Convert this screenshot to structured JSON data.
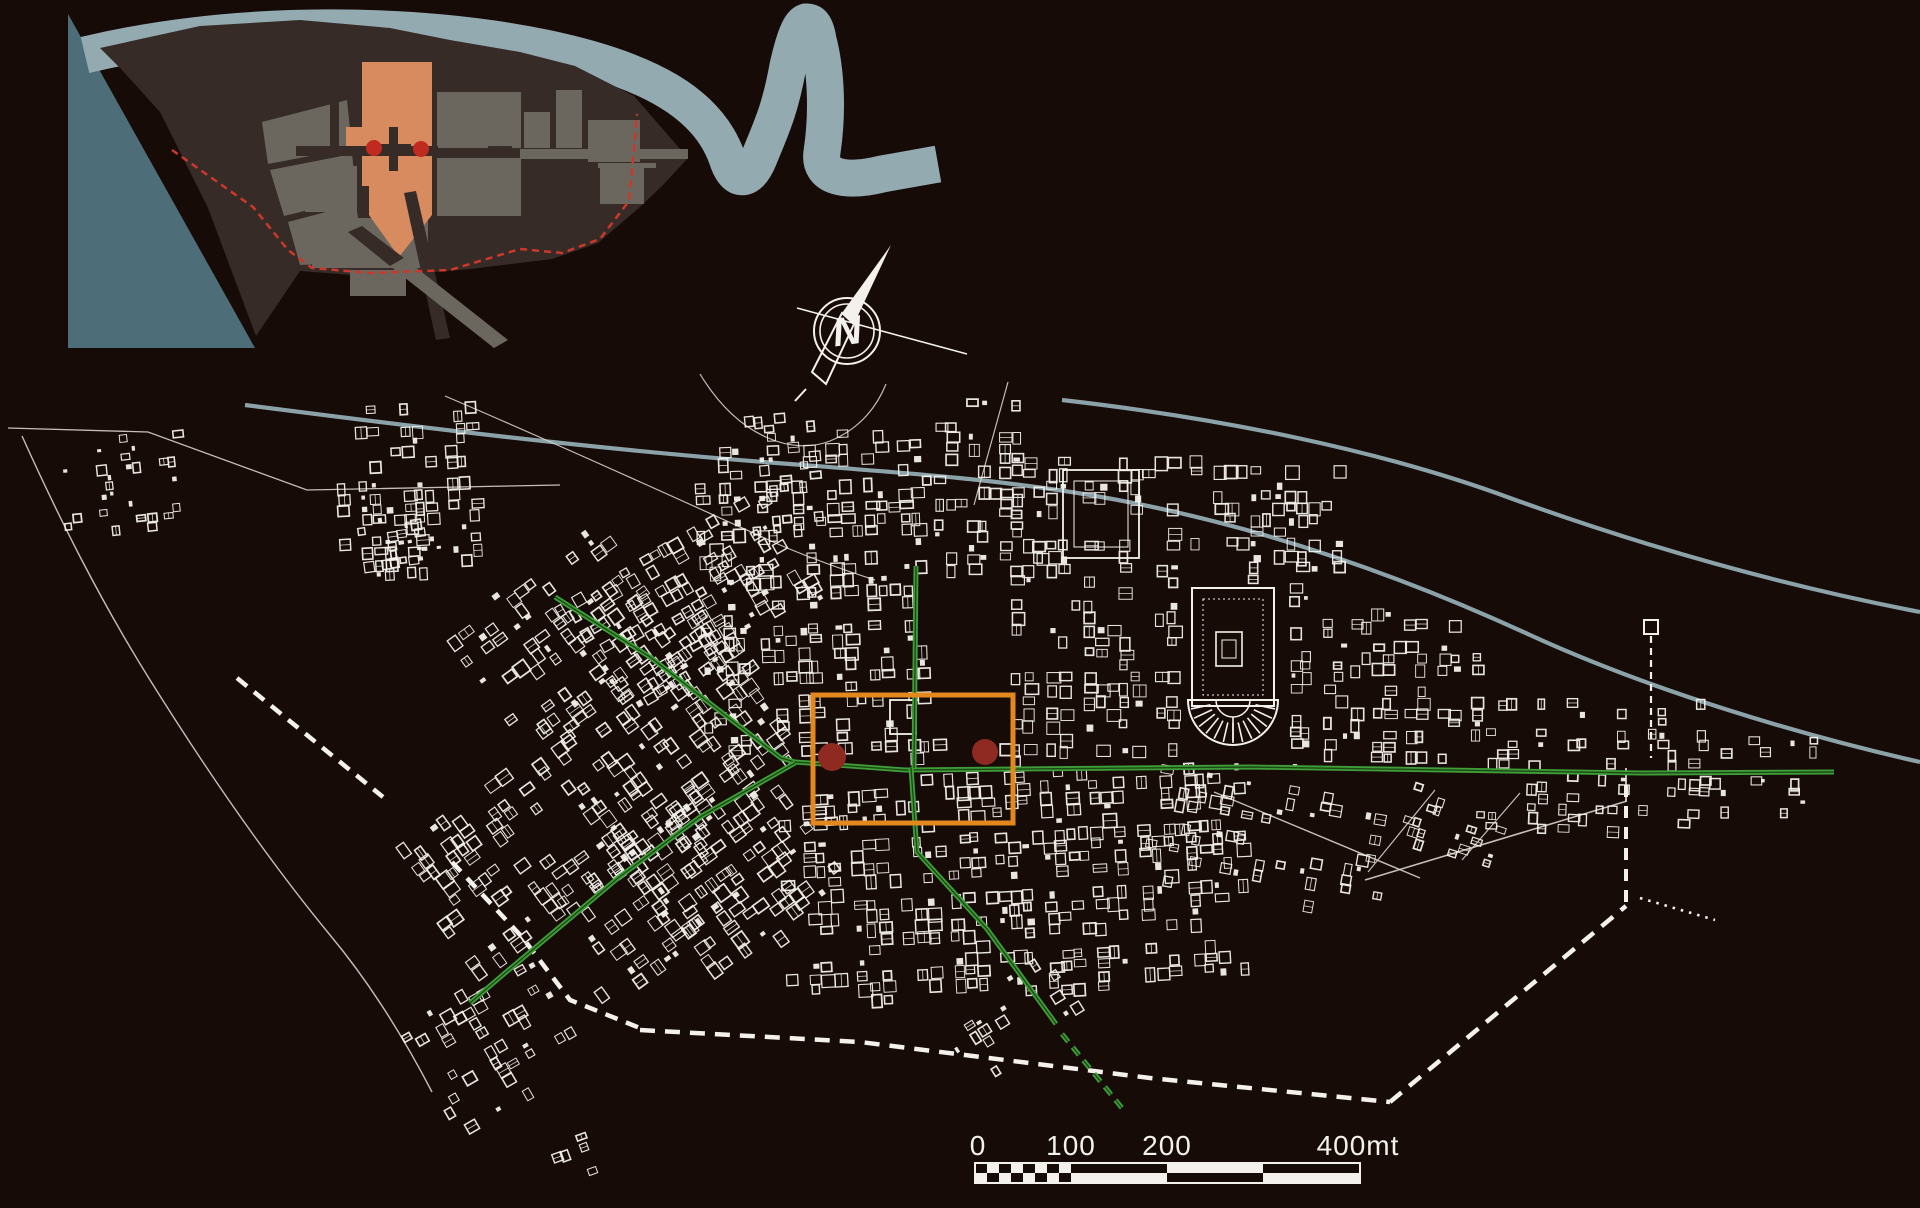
{
  "canvas": {
    "w": 1920,
    "h": 1208,
    "bg": "#170b08"
  },
  "palette": {
    "white": "#f4f1ec",
    "faint_white": "#d8d2cb",
    "river": "#8ba2a9",
    "band": "#94aab1",
    "sea": "#4d6d78",
    "land": "#362b26",
    "block": "#6b675f",
    "salmon": "#d98b60",
    "inset_red": "#c02a1f",
    "boundary_red": "#cb382b",
    "green": "#3f9e38",
    "green_dark": "#1c4a16",
    "orange": "#e2881f",
    "dot_red": "#8e2a22",
    "bg": "#170b08"
  },
  "scalebar": {
    "name": "scale-bar",
    "x": 975,
    "y": 1163,
    "h": 20,
    "len": 385,
    "checker_end": 96,
    "checker_cols": 8,
    "segments": [
      {
        "from": 96,
        "to": 192,
        "black": "top"
      },
      {
        "from": 192,
        "to": 288,
        "black": "bottom"
      },
      {
        "from": 288,
        "to": 385,
        "black": "top"
      }
    ],
    "labels": [
      {
        "t": "0",
        "x": 978
      },
      {
        "t": "100",
        "x": 1071
      },
      {
        "t": "200",
        "x": 1167
      },
      {
        "t": "400mt",
        "x": 1358
      }
    ],
    "font_size": 28
  },
  "compass": {
    "name": "north-arrow",
    "cx": 847,
    "cy": 331,
    "r_outer": 33,
    "r_inner": 27,
    "letter": "N",
    "letter_size": 40,
    "blade_filled": [
      [
        891,
        245
      ],
      [
        854,
        324
      ],
      [
        842,
        313
      ]
    ],
    "blade_outline": [
      [
        854,
        324
      ],
      [
        826,
        384
      ],
      [
        812,
        372
      ],
      [
        842,
        313
      ]
    ],
    "cross_line": [
      797,
      308,
      967,
      354
    ],
    "tail_tick": [
      806,
      389,
      795,
      401
    ]
  },
  "inset": {
    "name": "inset-overview-map",
    "sea": [
      [
        68,
        14
      ],
      [
        255,
        348
      ],
      [
        68,
        348
      ]
    ],
    "band": "M 85,55 C 240,18 420,22 545,48 C 650,70 708,104 727,158 C 734,181 748,185 759,158 C 772,126 780,110 788,66 C 793,44 799,24 806,22 C 812,22 816,26 818,40 C 826,70 828,112 822,152 C 818,178 846,183 882,174 L 938,164",
    "band_width": 37,
    "land": [
      [
        100,
        48
      ],
      [
        200,
        26
      ],
      [
        300,
        20
      ],
      [
        390,
        28
      ],
      [
        450,
        40
      ],
      [
        520,
        52
      ],
      [
        575,
        66
      ],
      [
        634,
        96
      ],
      [
        688,
        158
      ],
      [
        663,
        185
      ],
      [
        640,
        207
      ],
      [
        598,
        243
      ],
      [
        552,
        259
      ],
      [
        470,
        269
      ],
      [
        378,
        277
      ],
      [
        300,
        271
      ],
      [
        256,
        336
      ],
      [
        208,
        208
      ],
      [
        160,
        112
      ],
      [
        122,
        70
      ]
    ],
    "blocks": [
      {
        "poly": [
          [
            262,
            122
          ],
          [
            347,
            100
          ],
          [
            352,
            148
          ],
          [
            268,
            164
          ]
        ]
      },
      {
        "poly": [
          [
            270,
            170
          ],
          [
            352,
            154
          ],
          [
            357,
            198
          ],
          [
            284,
            216
          ]
        ]
      },
      {
        "poly": [
          [
            288,
            222
          ],
          [
            356,
            204
          ],
          [
            364,
            262
          ],
          [
            300,
            265
          ]
        ]
      },
      {
        "rect": [
          437,
          92,
          84,
          56
        ]
      },
      {
        "rect": [
          437,
          158,
          84,
          58
        ]
      },
      {
        "rect": [
          524,
          112,
          26,
          36
        ]
      },
      {
        "rect": [
          556,
          90,
          26,
          58
        ]
      },
      {
        "rect": [
          588,
          120,
          52,
          42
        ]
      },
      {
        "rect": [
          600,
          166,
          44,
          38
        ]
      },
      {
        "rect": [
          305,
          166,
          52,
          46
        ]
      },
      {
        "rect": [
          312,
          218,
          116,
          50
        ]
      },
      {
        "rect": [
          350,
          270,
          56,
          26
        ]
      },
      {
        "rect": [
          487,
          96,
          26,
          50
        ]
      }
    ],
    "theater_cut": {
      "cx": 500,
      "cy": 146,
      "r": 12
    },
    "salmon_poly": [
      [
        362,
        62
      ],
      [
        432,
        62
      ],
      [
        432,
        215
      ],
      [
        399,
        257
      ],
      [
        369,
        215
      ],
      [
        369,
        186
      ],
      [
        362,
        186
      ]
    ],
    "salmon_notch": [
      346,
      127,
      16,
      28
    ],
    "roads_dark": [
      {
        "rect": [
          296,
          146,
          142,
          10
        ]
      },
      {
        "rect": [
          330,
          88,
          9,
          58
        ]
      },
      {
        "poly": [
          [
            348,
            232
          ],
          [
            362,
            226
          ],
          [
            404,
            258
          ],
          [
            390,
            266
          ]
        ]
      },
      {
        "poly": [
          [
            404,
            193
          ],
          [
            416,
            191
          ],
          [
            450,
            338
          ],
          [
            436,
            340
          ]
        ]
      }
    ],
    "roads_gray": [
      {
        "rect": [
          520,
          149,
          168,
          10
        ]
      },
      {
        "rect": [
          598,
          163,
          58,
          5
        ]
      },
      {
        "poly": [
          [
            390,
            266
          ],
          [
            404,
            258
          ],
          [
            508,
            340
          ],
          [
            494,
            348
          ]
        ]
      }
    ],
    "cross": [
      [
        389,
        127,
        9,
        44
      ],
      [
        376,
        144,
        35,
        9
      ]
    ],
    "dots": [
      {
        "cx": 374,
        "cy": 148,
        "r": 8
      },
      {
        "cx": 421,
        "cy": 149,
        "r": 8
      }
    ],
    "boundary": "M 172,150 L 253,207 L 288,250 L 312,268 L 370,273 L 450,270 L 520,249 L 562,253 L 600,239 L 629,201 L 634,150 L 637,114",
    "boundary_width": 2.5,
    "boundary_dash": "7 5"
  },
  "main": {
    "name": "excavation-plan",
    "rivers": [
      {
        "name": "river-upper",
        "d": "M 1062,400 C 1220,418 1380,450 1510,498 C 1640,545 1780,585 1920,612",
        "w": 4.2
      },
      {
        "name": "river-lower",
        "d": "M 245,405 C 400,425 600,450 790,464 C 920,474 1000,480 1090,495 C 1250,522 1400,575 1530,635 C 1650,690 1800,735 1920,762",
        "w": 4.2
      }
    ],
    "thin_lines": [
      {
        "name": "coastline",
        "d": "M 22,436 C 60,520 100,600 150,680 C 200,760 260,850 330,935 C 370,983 405,1040 432,1092",
        "w": 1.4
      },
      {
        "name": "field-outline",
        "d": "M 8,428 L 148,432 L 307,490 L 560,485",
        "w": 1.3
      },
      {
        "name": "path-arc",
        "d": "M 700,374 C 740,440 795,455 830,441 C 862,428 878,404 886,384",
        "w": 1.2
      },
      {
        "name": "path-east",
        "d": "M 1008,382 L 974,505",
        "w": 1.2
      },
      {
        "name": "path-long",
        "d": "M 445,396 C 560,445 680,500 780,545 C 820,562 850,572 875,580",
        "w": 1.2
      },
      {
        "name": "road-se-1",
        "d": "M 1365,880 L 1627,801",
        "w": 1.6
      },
      {
        "name": "road-se-2",
        "d": "M 1214,792 L 1420,878",
        "w": 1.4
      },
      {
        "name": "road-se-3",
        "d": "M 1435,790 L 1368,872",
        "w": 1.2
      },
      {
        "name": "road-se-4",
        "d": "M 1520,793 L 1462,860",
        "w": 1.2
      },
      {
        "name": "wall-east-solid",
        "d": "M 1626,801 L 1626,768",
        "w": 2
      }
    ],
    "walls": [
      {
        "name": "wall-nw",
        "d": "M 237,678 L 383,797",
        "w": 4.5,
        "dash": "13 9"
      },
      {
        "name": "wall-sw",
        "d": "M 452,862 L 522,937 L 570,1000 L 640,1028",
        "w": 4.5,
        "dash": "13 9"
      },
      {
        "name": "wall-south",
        "d": "M 640,1030 L 860,1042 L 1150,1078 L 1390,1102",
        "w": 4.5,
        "dash": "15 10"
      },
      {
        "name": "wall-southeast",
        "d": "M 1390,1102 L 1626,906",
        "w": 4.5,
        "dash": "15 10"
      },
      {
        "name": "wall-east",
        "d": "M 1626,902 L 1626,778",
        "w": 4,
        "dash": "12 9"
      },
      {
        "name": "wall-aqueduct",
        "d": "M 1651,636 L 1651,758",
        "w": 2.2,
        "dash": "7 5"
      },
      {
        "name": "wall-spur-dotted",
        "d": "M 1640,898 L 1715,920",
        "w": 2.6,
        "dash": "2.5 6"
      }
    ],
    "wall_tower": {
      "x": 1644,
      "y": 620,
      "w": 14,
      "h": 14
    },
    "greens": [
      {
        "name": "via-della-foce",
        "d": "M 555,597 L 650,657 L 725,715 L 781,758 L 795,762"
      },
      {
        "name": "decumanus-maximus",
        "d": "M 795,762 L 905,770 L 1250,767 L 1640,773 L 1834,772"
      },
      {
        "name": "decumanus-west",
        "d": "M 795,763 L 700,817 L 618,878 L 505,973 L 470,1003"
      },
      {
        "name": "cardo-north",
        "d": "M 916,566 L 914,768"
      },
      {
        "name": "cardo-south",
        "d": "M 911,768 L 917,852 L 987,929 L 1056,1024"
      }
    ],
    "green_dashed": {
      "name": "cardo-south-dashed",
      "d": "M 1062,1034 L 1122,1108",
      "dash": "10 7"
    },
    "clusters": [
      {
        "name": "nw-outlier",
        "x": 62,
        "y": 436,
        "w": 118,
        "h": 92,
        "angle": -6,
        "cell": 9,
        "density": 0.32,
        "seed": 11
      },
      {
        "name": "garden-houses",
        "x": 338,
        "y": 404,
        "w": 140,
        "h": 170,
        "angle": -3,
        "cell": 11,
        "density": 0.52,
        "seed": 21
      },
      {
        "name": "west-complex",
        "x": 352,
        "y": 514,
        "w": 86,
        "h": 58,
        "angle": -8,
        "cell": 9,
        "density": 0.45,
        "seed": 31
      },
      {
        "name": "foce-strip",
        "x": 570,
        "y": 540,
        "w": 240,
        "h": 130,
        "angle": -30,
        "cell": 11,
        "density": 0.5,
        "seed": 41
      },
      {
        "name": "west-quarter-1",
        "x": 470,
        "y": 560,
        "w": 190,
        "h": 160,
        "angle": -36,
        "cell": 12,
        "density": 0.6,
        "seed": 51
      },
      {
        "name": "west-quarter-2",
        "x": 545,
        "y": 660,
        "w": 230,
        "h": 170,
        "angle": -36,
        "cell": 12,
        "density": 0.62,
        "seed": 61
      },
      {
        "name": "west-quarter-3",
        "x": 640,
        "y": 780,
        "w": 180,
        "h": 170,
        "angle": -36,
        "cell": 12,
        "density": 0.6,
        "seed": 71
      },
      {
        "name": "southwest-quarter",
        "x": 545,
        "y": 820,
        "w": 170,
        "h": 150,
        "angle": -36,
        "cell": 12,
        "density": 0.55,
        "seed": 81
      },
      {
        "name": "porta-marina",
        "x": 420,
        "y": 795,
        "w": 150,
        "h": 160,
        "angle": -36,
        "cell": 12,
        "density": 0.55,
        "seed": 91
      },
      {
        "name": "terme-marina",
        "x": 418,
        "y": 980,
        "w": 150,
        "h": 130,
        "angle": -30,
        "cell": 11,
        "density": 0.42,
        "seed": 241
      },
      {
        "name": "shore-fragments",
        "x": 540,
        "y": 1140,
        "w": 60,
        "h": 55,
        "angle": -20,
        "cell": 9,
        "density": 0.3,
        "seed": 251
      },
      {
        "name": "central-north",
        "x": 700,
        "y": 432,
        "w": 240,
        "h": 332,
        "angle": -2,
        "cell": 12,
        "density": 0.58,
        "seed": 101
      },
      {
        "name": "palazzo-spur",
        "x": 750,
        "y": 415,
        "w": 62,
        "h": 125,
        "angle": -5,
        "cell": 10,
        "density": 0.45,
        "seed": 111
      },
      {
        "name": "north-spur",
        "x": 935,
        "y": 400,
        "w": 102,
        "h": 168,
        "angle": 0,
        "cell": 11,
        "density": 0.5,
        "seed": 121
      },
      {
        "name": "horrea-block",
        "x": 1000,
        "y": 445,
        "w": 190,
        "h": 320,
        "angle": 0,
        "cell": 12,
        "density": 0.55,
        "seed": 131
      },
      {
        "name": "piazzale-north",
        "x": 1190,
        "y": 455,
        "w": 150,
        "h": 128,
        "angle": 0,
        "cell": 12,
        "density": 0.55,
        "seed": 141
      },
      {
        "name": "piazzale-east",
        "x": 1280,
        "y": 585,
        "w": 60,
        "h": 180,
        "angle": 0,
        "cell": 11,
        "density": 0.5,
        "seed": 151
      },
      {
        "name": "east-block",
        "x": 1340,
        "y": 610,
        "w": 138,
        "h": 155,
        "angle": 0,
        "cell": 11,
        "density": 0.5,
        "seed": 161
      },
      {
        "name": "east-strip-north",
        "x": 1478,
        "y": 700,
        "w": 225,
        "h": 62,
        "angle": 0,
        "cell": 10,
        "density": 0.3,
        "seed": 171
      },
      {
        "name": "east-strip-south",
        "x": 1478,
        "y": 775,
        "w": 225,
        "h": 58,
        "angle": 2,
        "cell": 10,
        "density": 0.28,
        "seed": 181
      },
      {
        "name": "porta-romana",
        "x": 1700,
        "y": 738,
        "w": 138,
        "h": 80,
        "angle": 0,
        "cell": 10,
        "density": 0.3,
        "seed": 191
      },
      {
        "name": "south-central",
        "x": 782,
        "y": 772,
        "w": 458,
        "h": 228,
        "angle": -3,
        "cell": 12,
        "density": 0.58,
        "seed": 201
      },
      {
        "name": "laurentina-taper",
        "x": 945,
        "y": 975,
        "w": 150,
        "h": 75,
        "angle": -32,
        "cell": 10,
        "density": 0.4,
        "seed": 211
      },
      {
        "name": "southeast-quarter",
        "x": 1150,
        "y": 772,
        "w": 235,
        "h": 128,
        "angle": 10,
        "cell": 11,
        "density": 0.42,
        "seed": 221
      },
      {
        "name": "southeast-sparse",
        "x": 1378,
        "y": 790,
        "w": 120,
        "h": 62,
        "angle": 18,
        "cell": 9,
        "density": 0.22,
        "seed": 231
      }
    ],
    "landmarks": [
      {
        "type": "rect",
        "name": "piazzale-corporazioni",
        "x": 1192,
        "y": 588,
        "w": 82,
        "h": 118,
        "sw": 2
      },
      {
        "type": "rect-dashed",
        "name": "piazzale-portico",
        "x": 1203,
        "y": 599,
        "w": 60,
        "h": 96,
        "sw": 1,
        "dash": "2 3"
      },
      {
        "type": "rect",
        "name": "piazzale-temple",
        "x": 1216,
        "y": 632,
        "w": 26,
        "h": 34,
        "sw": 1.6
      },
      {
        "type": "rect",
        "name": "piazzale-temple-cella",
        "x": 1222,
        "y": 640,
        "w": 14,
        "h": 18,
        "sw": 1
      },
      {
        "type": "theater",
        "name": "theater",
        "cx": 1233,
        "cy": 700,
        "r": 45,
        "r2": 17,
        "ticks": 13
      },
      {
        "type": "rect",
        "name": "grandi-horrea",
        "x": 1063,
        "y": 470,
        "w": 76,
        "h": 88,
        "sw": 1.8
      },
      {
        "type": "rect",
        "name": "grandi-horrea-court",
        "x": 1074,
        "y": 481,
        "w": 54,
        "h": 66,
        "sw": 1
      },
      {
        "type": "rect",
        "name": "forum-temple",
        "x": 890,
        "y": 700,
        "w": 26,
        "h": 34,
        "sw": 1.8
      }
    ],
    "highlight": {
      "name": "focus-rectangle",
      "x": 813,
      "y": 695,
      "w": 200,
      "h": 128,
      "stroke_w": 5,
      "dots": [
        {
          "name": "focus-dot-west",
          "cx": 832,
          "cy": 757,
          "r": 14
        },
        {
          "name": "focus-dot-east",
          "cx": 985,
          "cy": 752,
          "r": 13
        }
      ]
    }
  }
}
